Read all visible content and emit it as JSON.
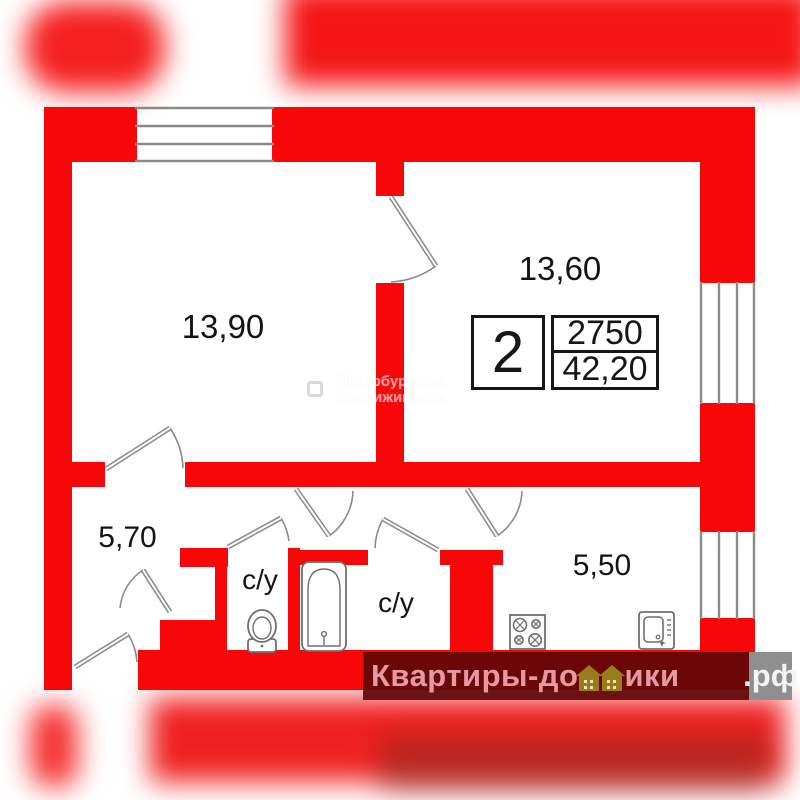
{
  "plan": {
    "rooms": [
      {
        "id": "living-room-1",
        "label": "13,90"
      },
      {
        "id": "living-room-2",
        "label": "13,60"
      },
      {
        "id": "hallway",
        "label": "5,70"
      },
      {
        "id": "kitchen",
        "label": "5,50"
      },
      {
        "id": "bathroom-wc",
        "label": "с/у"
      },
      {
        "id": "bathroom-bath",
        "label": "с/у"
      }
    ],
    "info_box": {
      "rooms_count": "2",
      "ceiling_height": "2750",
      "total_area": "42,20"
    },
    "colors": {
      "wall_red": "#f70707",
      "line_gray": "#8a8a8a",
      "watermark_maroon": "#600808",
      "watermark_gold": "#9a7c1c"
    }
  },
  "watermarks": {
    "center": {
      "line1": "Петербургская",
      "line2": "недвижимость"
    },
    "bottom": {
      "part1": "Квартиры-до",
      "part2": "ики",
      "part3": ".рф"
    }
  }
}
